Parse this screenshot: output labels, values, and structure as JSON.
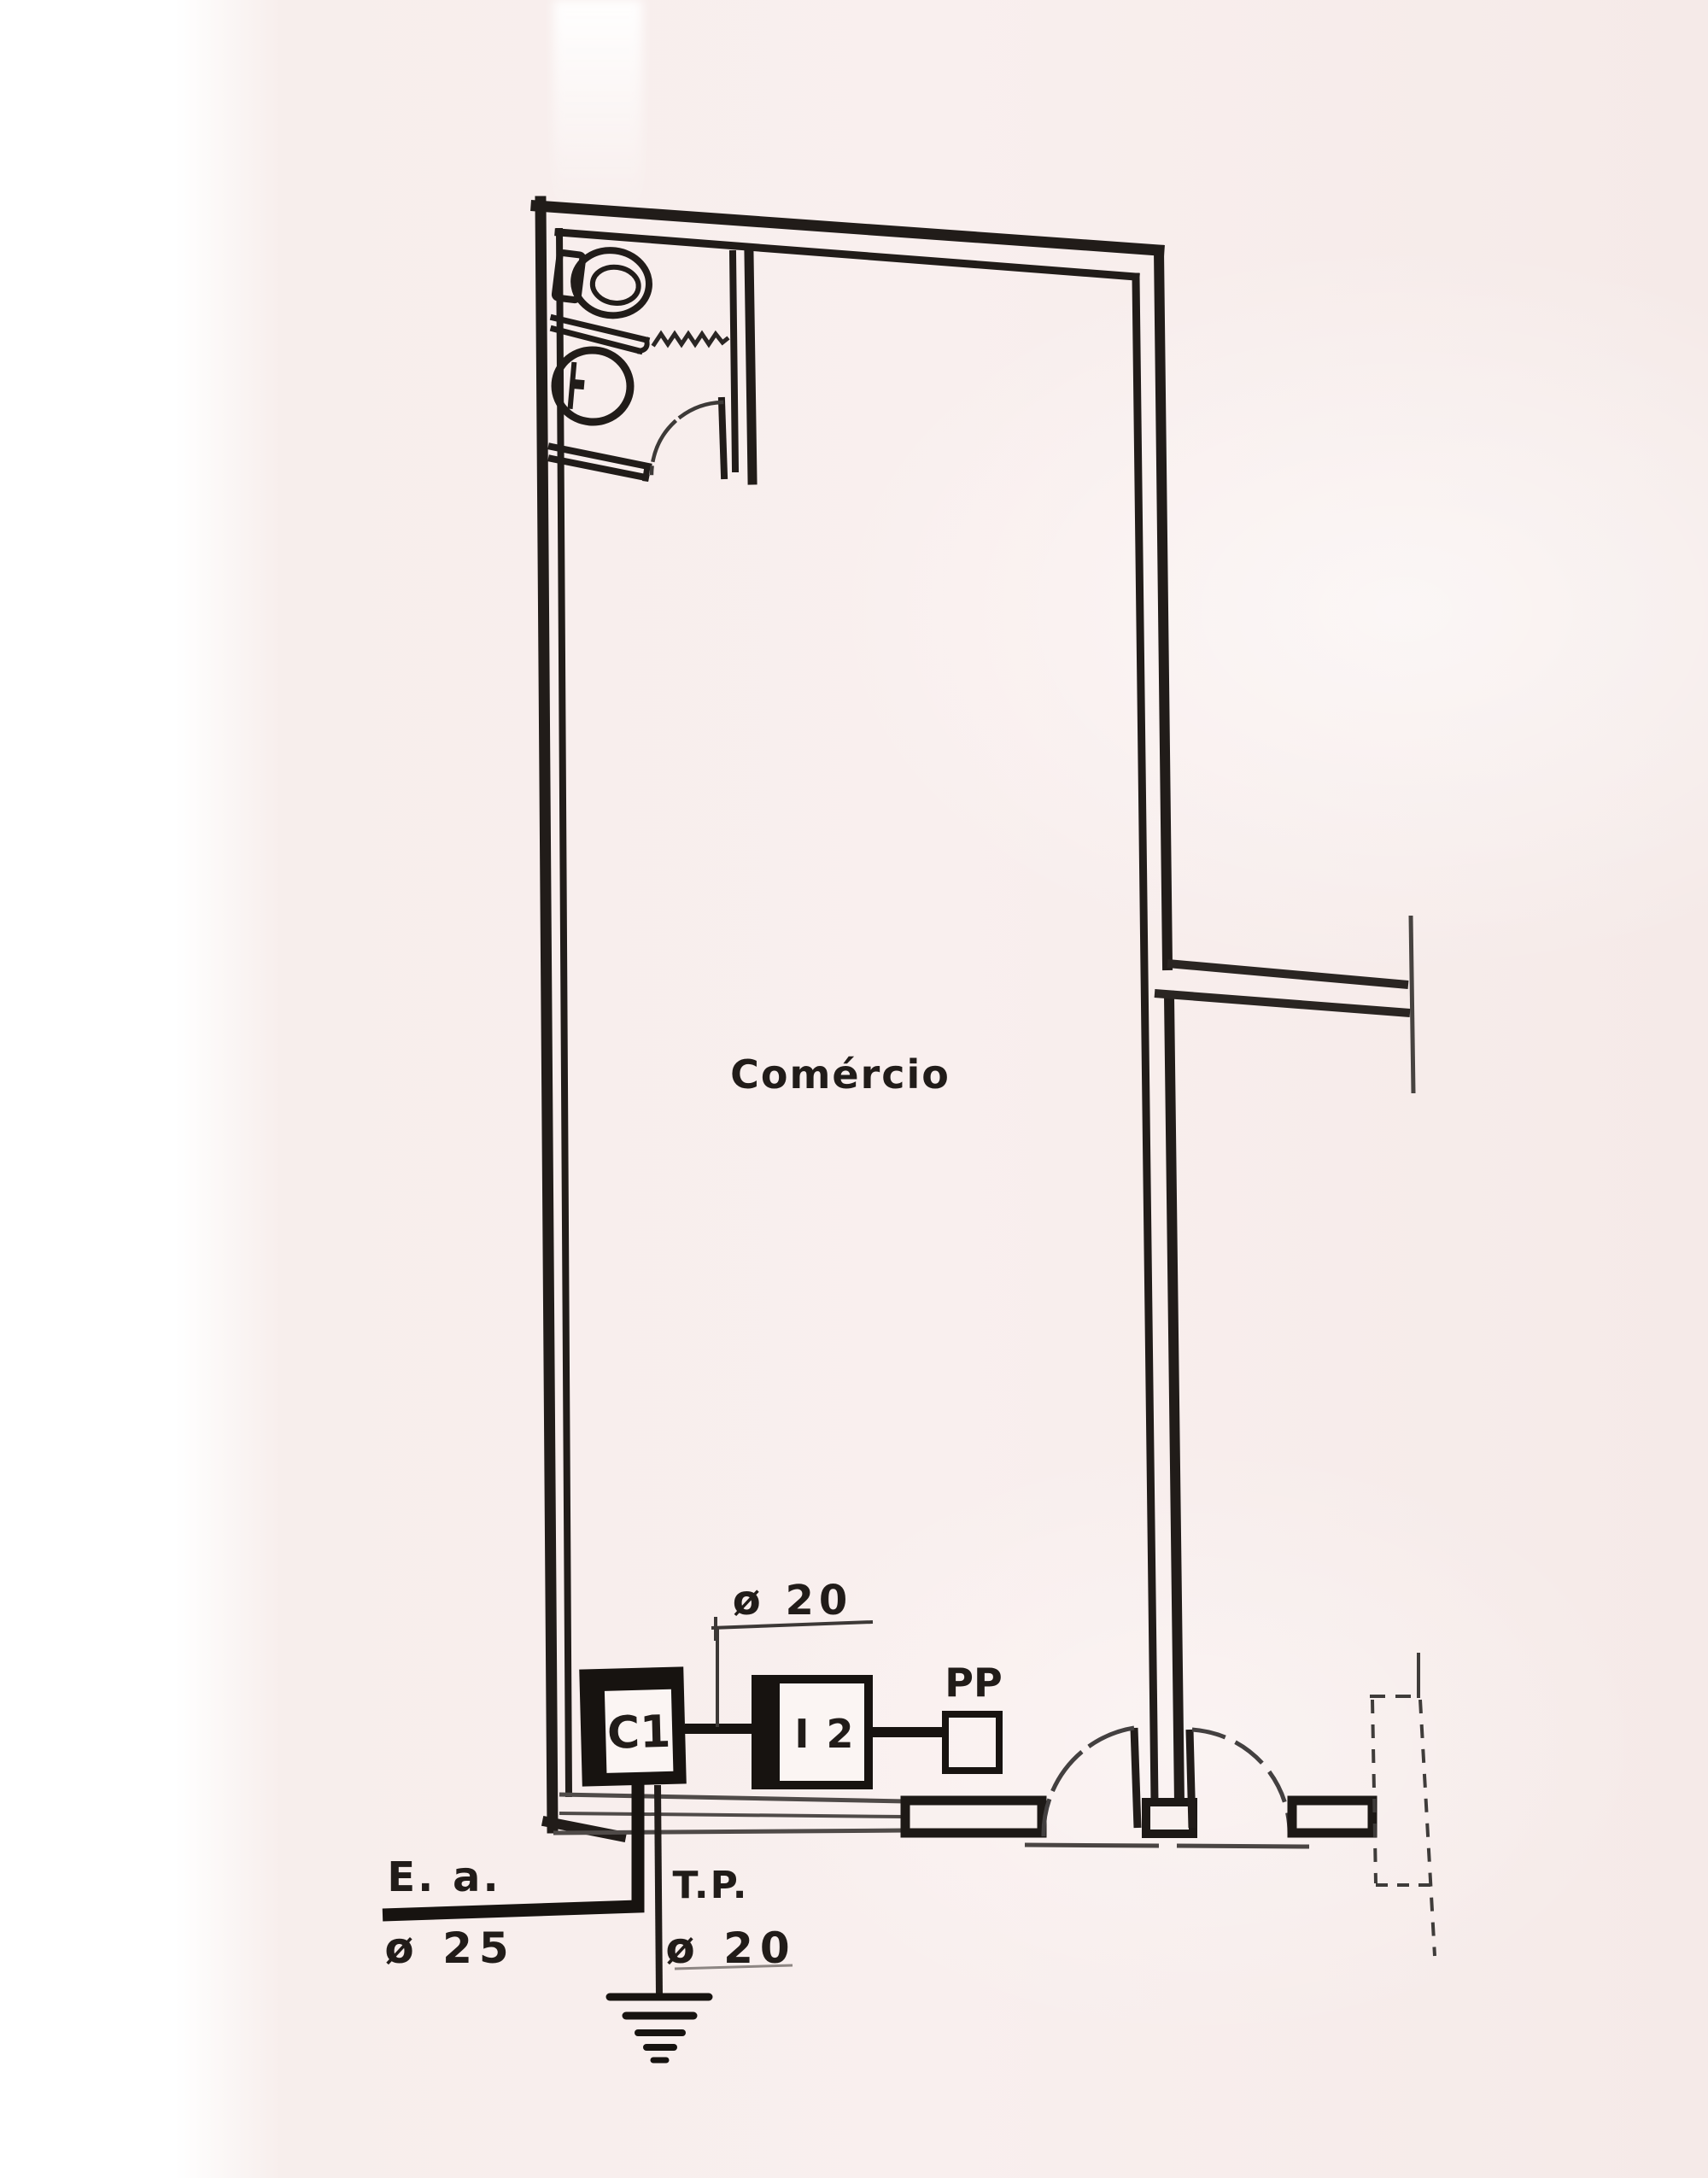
{
  "colors": {
    "paper": "#f8efed",
    "ink": "#211c19",
    "thin_line": "#4a4543"
  },
  "room": {
    "label": "Comércio"
  },
  "devices": {
    "c1": "C1",
    "i2": "I 2",
    "pp": "PP"
  },
  "annotations": {
    "top_conduit_dim": "ø 20",
    "feeder_label": "E. a.",
    "feeder_dim": "ø 25",
    "ground_label": "T.P.",
    "ground_dim": "ø 20"
  },
  "icons": {
    "toilet": "toilet-icon",
    "sink": "sink-icon",
    "shower_screen": "shower-screen-zigzag-icon",
    "door_swing": "door-swing-icon",
    "earth_ground": "earth-ground-icon"
  }
}
